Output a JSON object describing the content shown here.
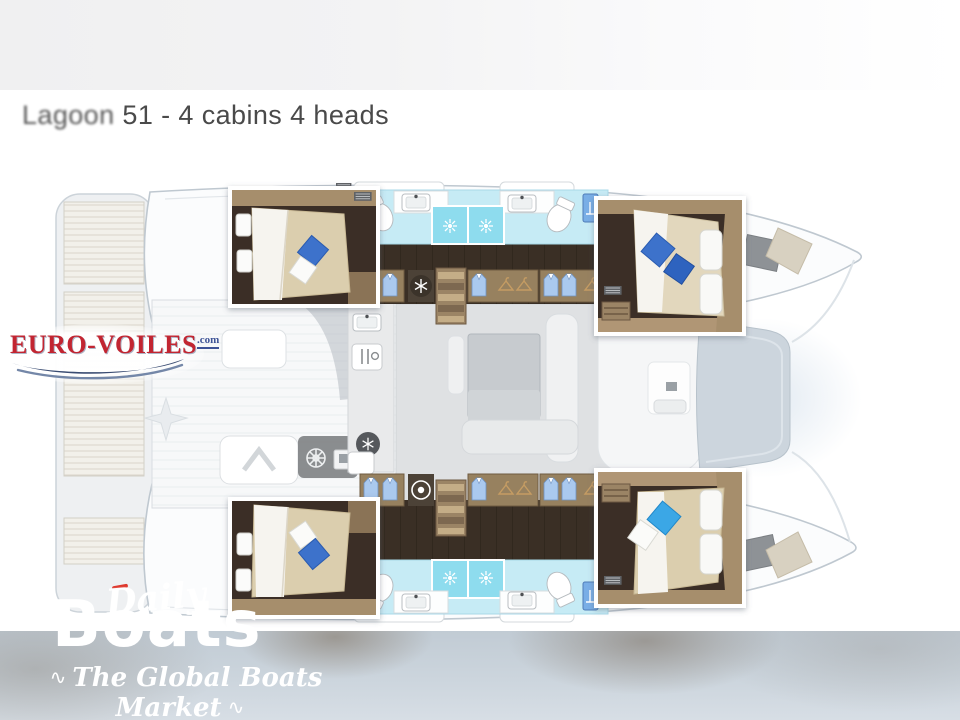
{
  "header": {
    "brand_word": "Lagoon",
    "title_rest": " 51 - 4 cabins 4 heads"
  },
  "logo_eurovoiles": {
    "text": "EURO-VOILES",
    "suffix": ".com",
    "text_color": "#c22531",
    "swoosh_color": "#3a4c72"
  },
  "watermark_dailyboats": {
    "word_daily": "Daily",
    "word_boats": "Boats",
    "tagline": "The Global Boats Market",
    "flourish_left": "∿",
    "flourish_right": "∿"
  },
  "plan": {
    "type": "catamaran-deck-plan",
    "cabins_shown": 4,
    "heads_shown": 4,
    "colors": {
      "head_floor": "#c6ebf5",
      "shower_tile": "#8edcee",
      "cabin_floor": "#3b2f26",
      "wood_trim": "#a68e6c",
      "wood_trim_light": "#b09674",
      "wood_wardrobe": "#97815f",
      "corridor_plank": "#3a2f25",
      "bed_linen": "#dbceae",
      "duvet_white": "#f6f4ef",
      "pillow_blue": "#3d72cb",
      "pillow_blue_dark": "#2f63bf",
      "pillow_sky_blue": "#3aa7e6",
      "hull_fill": "#fbfcfd",
      "hull_outline": "#bfc8d0",
      "saloon_floor": "#dfe1e3",
      "table_gray": "#c7cbcf",
      "windshield": "#ccd5dd",
      "hatch_gray": "#8e9296",
      "sunpad_beige": "#d8d1c1"
    },
    "icons": [
      "shower-sunburst-icon",
      "snowflake-icon",
      "washing-machine-icon",
      "wardrobe-shirt-icon",
      "hanger-icon",
      "helm-wheel-icon",
      "compass-star-icon",
      "toilet-icon",
      "sink-icon",
      "stairs-icon",
      "vent-grille-icon",
      "galley-cutlery-icon"
    ]
  }
}
